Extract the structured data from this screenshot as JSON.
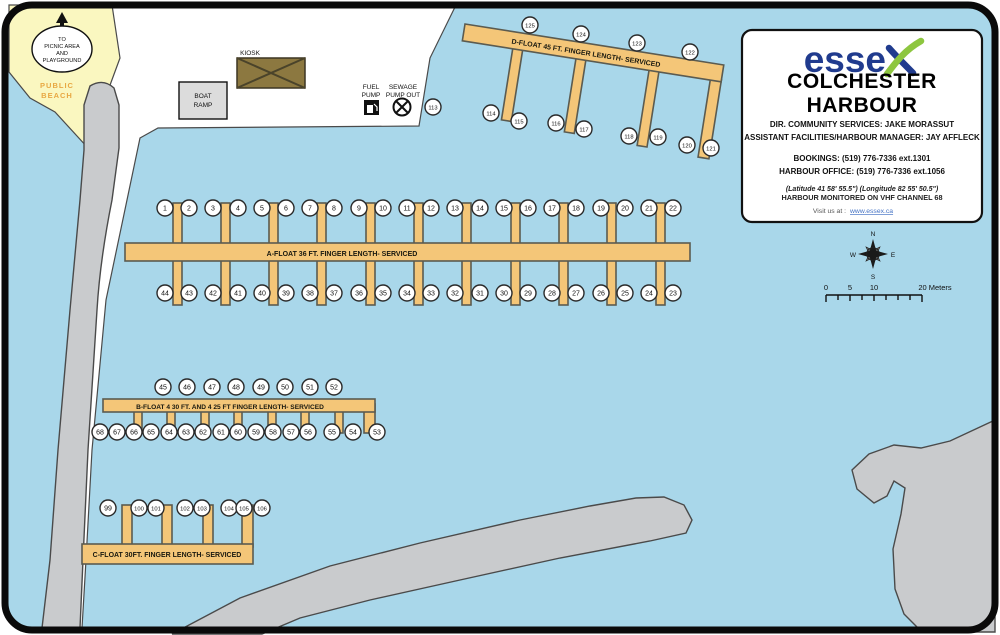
{
  "map": {
    "info_box": {
      "brand": "esse",
      "title_line1": "COLCHESTER",
      "title_line2": "HARBOUR",
      "director_line": "DIR. COMMUNITY SERVICES: JAKE MORASSUT",
      "assistant_line": "ASSISTANT FACILITIES/HARBOUR MANAGER: JAY AFFLECK",
      "bookings_line": "BOOKINGS: (519) 776-7336 ext.1301",
      "office_line": "HARBOUR OFFICE: (519) 776-7336 ext.1056",
      "coordinates_line": "(Latitude 41 58' 55.5\") (Longitude 82 55' 50.5\")",
      "vhf_line": "HARBOUR MONITORED ON VHF CHANNEL 68",
      "visit_label": "Visit us at :",
      "visit_url": "www.essex.ca"
    },
    "labels": {
      "picnic_sign": [
        "TO",
        "PICNIC AREA",
        "AND",
        "PLAYGROUND"
      ],
      "public_beach": [
        "PUBLIC",
        "BEACH"
      ],
      "boat_ramp": [
        "BOAT",
        "RAMP"
      ],
      "kiosk": "KIOSK",
      "fuel_pump": [
        "FUEL",
        "PUMP"
      ],
      "sewage": [
        "SEWAGE",
        "PUMP OUT"
      ]
    },
    "floats": {
      "a_label": "A-FLOAT 36 FT. FINGER LENGTH- SERVICED",
      "b_label": "B-FLOAT 4 30 FT. AND 4 25 FT FINGER LENGTH- SERVICED",
      "c_label": "C-FLOAT 30FT. FINGER LENGTH- SERVICED",
      "d_label": "D-FLOAT 45 FT. FINGER LENGTH- SERVICED"
    },
    "slip_rows": [
      {
        "float": "A",
        "side": "top",
        "y": 208,
        "numbers": [
          1,
          2,
          3,
          4,
          5,
          6,
          7,
          8,
          9,
          10,
          11,
          12,
          13,
          14,
          15,
          16,
          17,
          18,
          19,
          20,
          21,
          22
        ],
        "x": [
          165,
          189,
          213,
          238,
          262,
          286,
          310,
          334,
          359,
          383,
          407,
          431,
          455,
          480,
          504,
          528,
          552,
          576,
          601,
          625,
          649,
          673
        ]
      },
      {
        "float": "A",
        "side": "bottom",
        "y": 293,
        "numbers": [
          44,
          43,
          42,
          41,
          40,
          39,
          38,
          37,
          36,
          35,
          34,
          33,
          32,
          31,
          30,
          29,
          28,
          27,
          26,
          25,
          24,
          23
        ],
        "x": [
          165,
          189,
          213,
          238,
          262,
          286,
          310,
          334,
          359,
          383,
          407,
          431,
          455,
          480,
          504,
          528,
          552,
          576,
          601,
          625,
          649,
          673
        ]
      },
      {
        "float": "B",
        "side": "top",
        "y": 387,
        "numbers": [
          45,
          46,
          47,
          48,
          49,
          50,
          51,
          52
        ],
        "x": [
          163,
          187,
          212,
          236,
          261,
          285,
          310,
          334
        ]
      },
      {
        "float": "B",
        "side": "bottom",
        "y": 432,
        "numbers": [
          68,
          67,
          66,
          65,
          64,
          63,
          62,
          61,
          60,
          59,
          58,
          57,
          56,
          55,
          54,
          53
        ],
        "x": [
          100,
          117,
          134,
          151,
          169,
          186,
          203,
          221,
          238,
          256,
          273,
          291,
          308,
          332,
          353,
          377
        ]
      },
      {
        "float": "C",
        "side": "top",
        "y": 508,
        "numbers": [
          99,
          100,
          101,
          102,
          103,
          104,
          105,
          106
        ],
        "x": [
          108,
          139,
          156,
          185,
          202,
          229,
          244,
          262
        ]
      },
      {
        "float": "D",
        "side": "top",
        "y": [
          25,
          34,
          43,
          52
        ],
        "numbers": [
          125,
          124,
          123,
          122
        ],
        "x": [
          530,
          581,
          637,
          690
        ]
      },
      {
        "float": "D",
        "side": "bottom",
        "y": [
          113,
          121,
          123,
          129,
          136,
          137,
          145,
          148
        ],
        "numbers": [
          114,
          115,
          116,
          117,
          118,
          119,
          120,
          121
        ],
        "x": [
          491,
          519,
          556,
          584,
          629,
          658,
          687,
          711
        ]
      },
      {
        "float": "D",
        "side": "approach",
        "y": 107,
        "numbers": [
          113
        ],
        "x": [
          433
        ]
      }
    ],
    "compass": {
      "n": "N",
      "e": "E",
      "s": "S",
      "w": "W"
    },
    "scale_bar": {
      "t0": "0",
      "t5": "5",
      "t10": "10",
      "t20": "20 Meters"
    },
    "colors": {
      "water": "#A9D7EA",
      "land": "#FFFFFF",
      "beach": "#FAF7C0",
      "dock": "#F4C678",
      "breakwater": "#C9CBCD",
      "kiosk": "#8C7840",
      "brand_blue": "#203B8E",
      "brand_green": "#8DC63F",
      "beach_text": "#E8A843",
      "link": "#4472C4"
    }
  }
}
